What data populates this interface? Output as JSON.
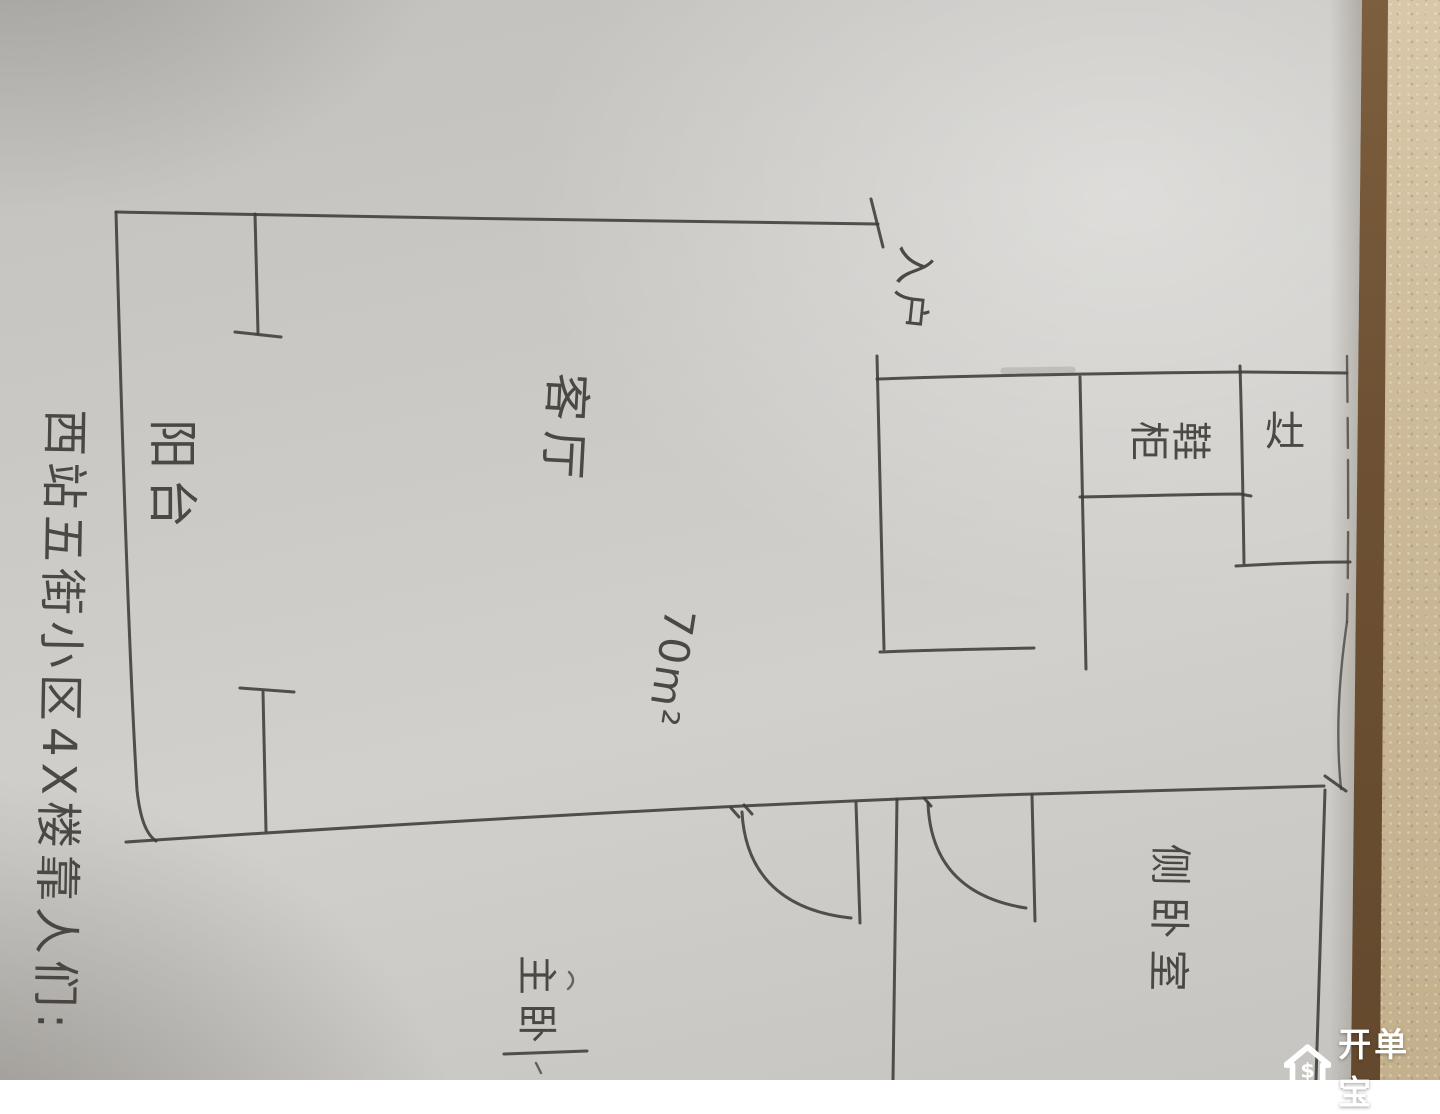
{
  "photo": {
    "description": "hand-drawn apartment floor plan sketch on paper, photographed sideways"
  },
  "annotations": {
    "side_note": "西站五街小区4X楼靠人们:",
    "balcony": "阳台",
    "living_room": "客厅",
    "area": "70m²",
    "entrance": "入户",
    "shoe_cabinet": "鞋柜",
    "stove": "灶",
    "master_bedroom": "主卧",
    "secondary_bedroom": "侧卧室"
  },
  "watermark": {
    "brand": "开单宝",
    "icon": "house-dollar-icon",
    "symbol": "$"
  },
  "colors": {
    "ink": "#3f3c38",
    "paper": "#cbc9c5",
    "wall_texture": "#cdbb9b",
    "wood_trim": "#6e5134",
    "watermark_text": "#ffffff"
  }
}
